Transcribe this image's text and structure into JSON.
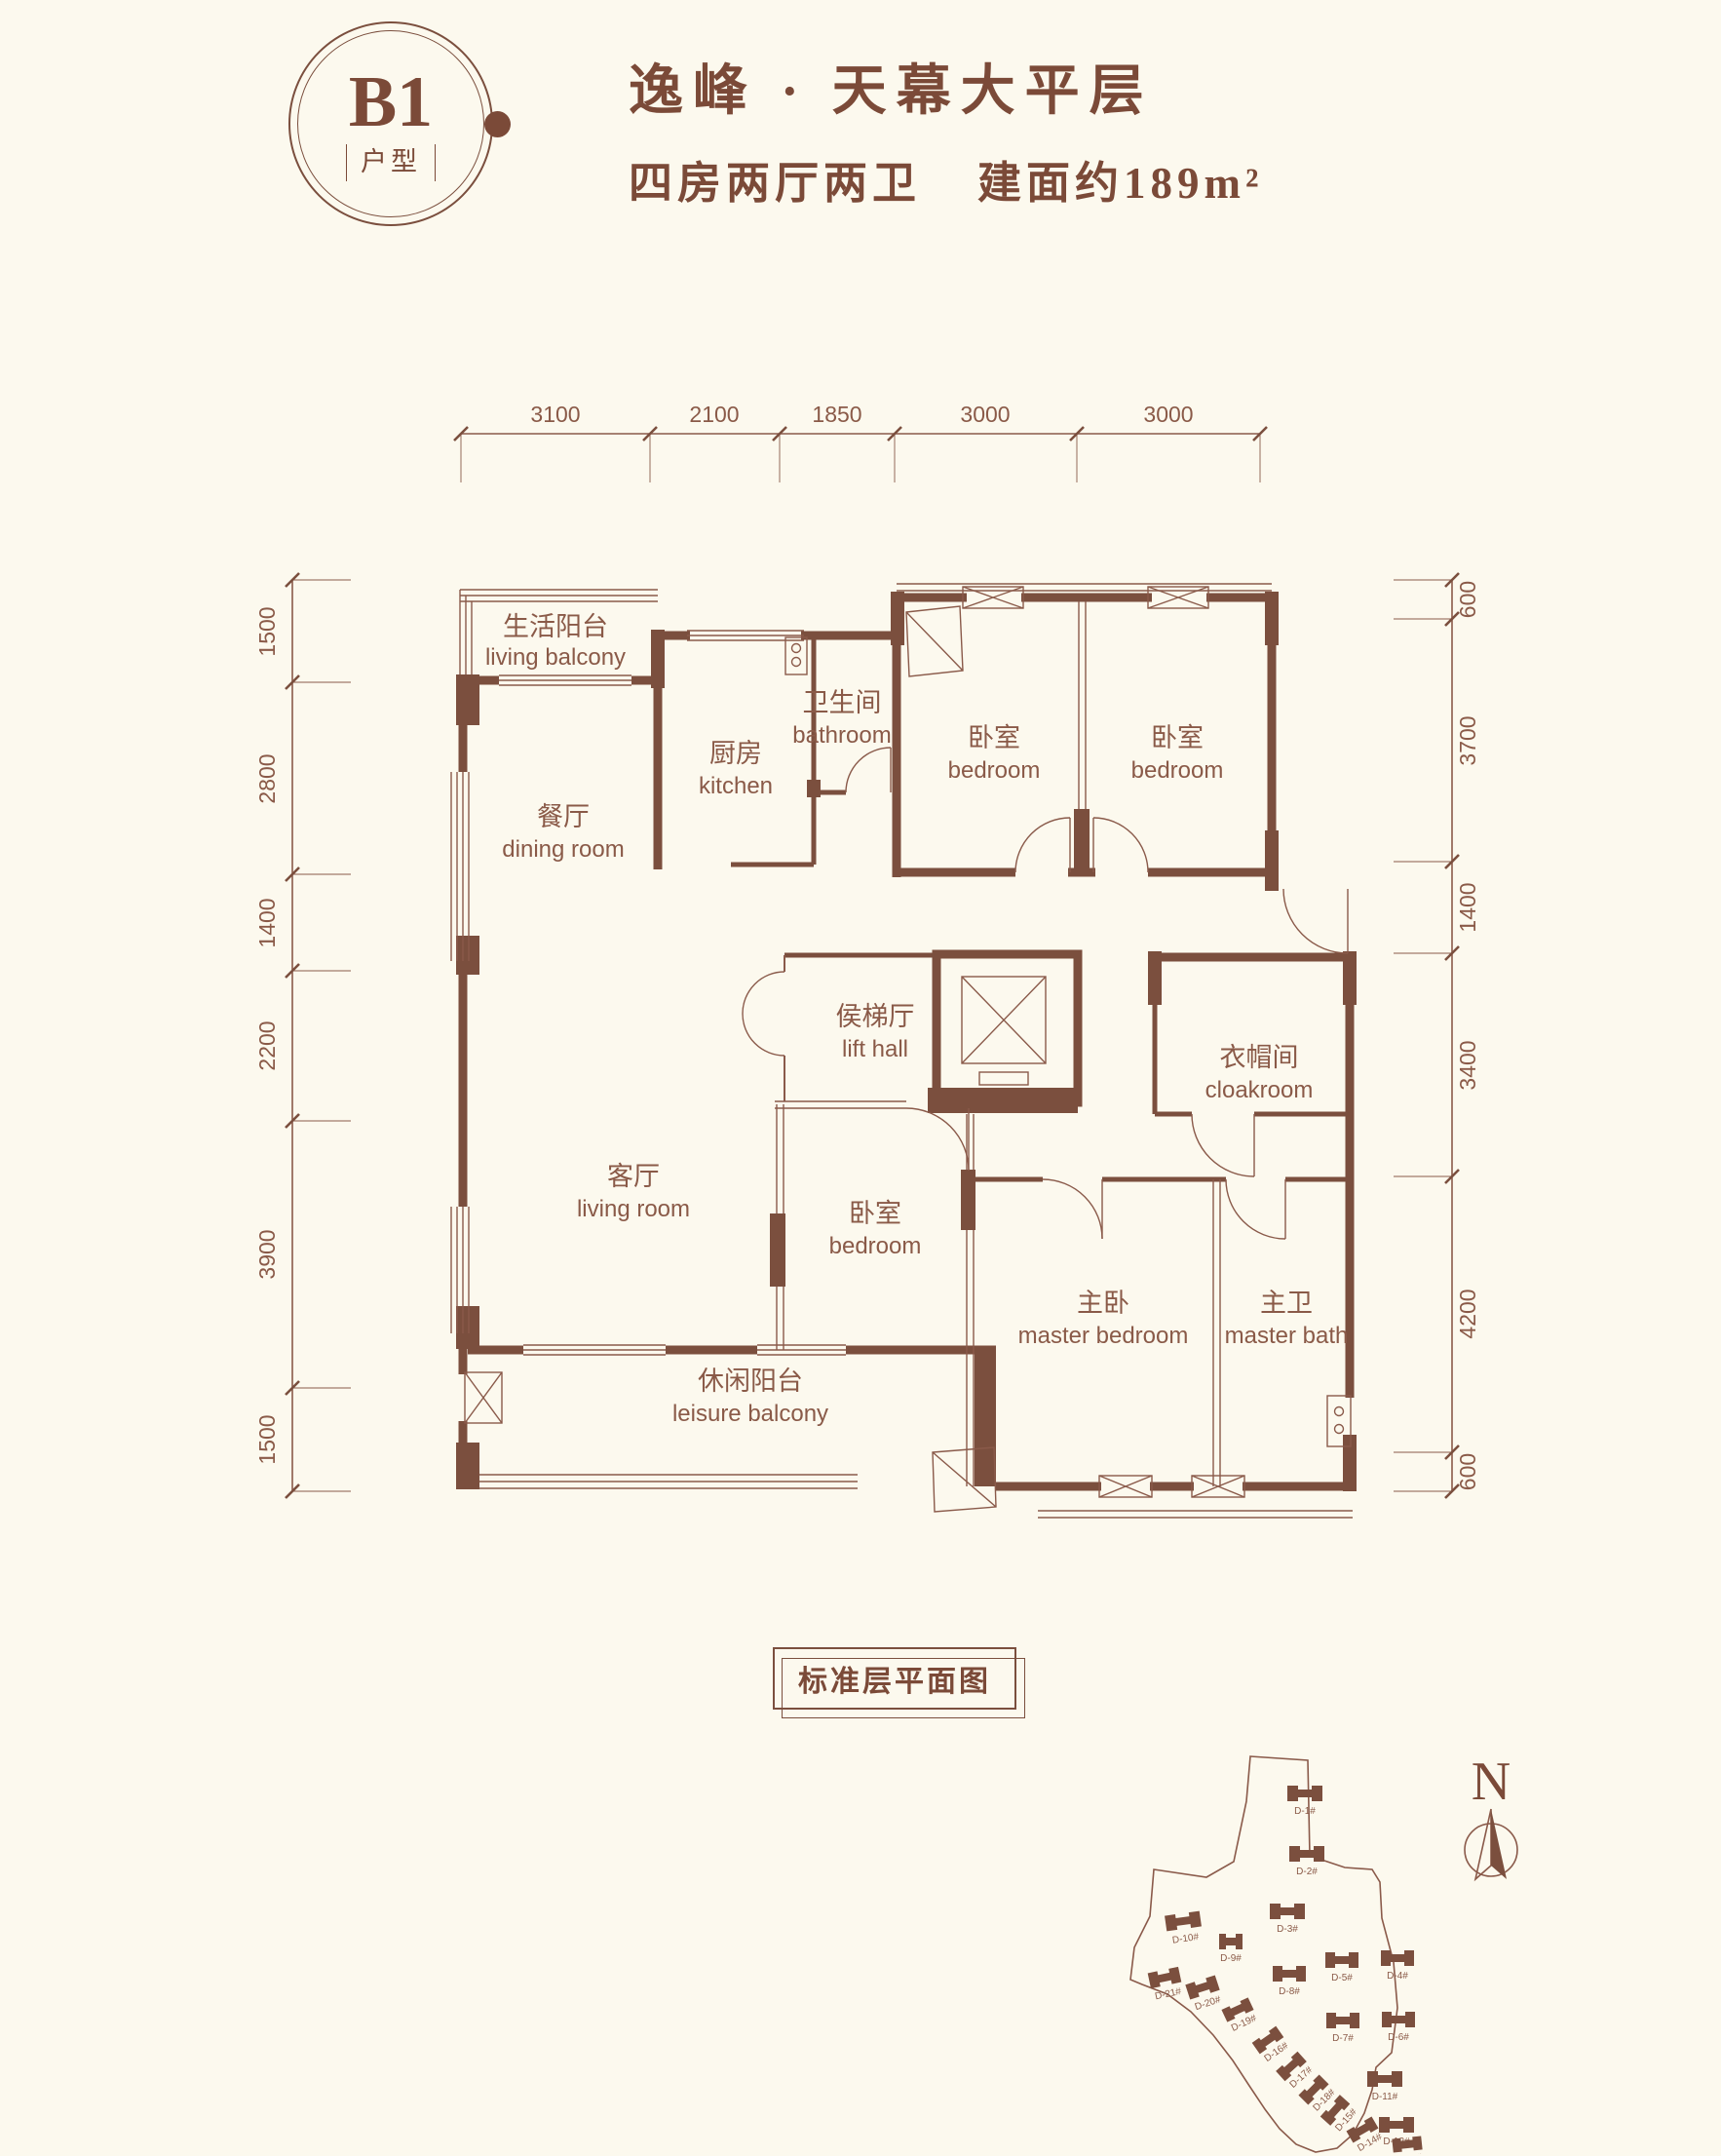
{
  "page": {
    "background": "#fcf9ee",
    "accent": "#8a5a48",
    "wall_color": "#7b4f3e"
  },
  "header": {
    "badge": {
      "code": "B1",
      "label": "户型"
    },
    "title": "逸峰 · 天幕大平层",
    "subtitle": {
      "rooms": "四房两厅两卫",
      "area": "建面约189m²"
    }
  },
  "floor_plan": {
    "rooms": {
      "living_balcony": {
        "cn": "生活阳台",
        "en": "living balcony"
      },
      "dining_room": {
        "cn": "餐厅",
        "en": "dining room"
      },
      "kitchen": {
        "cn": "厨房",
        "en": "kitchen"
      },
      "bathroom": {
        "cn": "卫生间",
        "en": "bathroom"
      },
      "bedroom_top_left": {
        "cn": "卧室",
        "en": "bedroom"
      },
      "bedroom_top_right": {
        "cn": "卧室",
        "en": "bedroom"
      },
      "lift_hall": {
        "cn": "侯梯厅",
        "en": "lift hall"
      },
      "cloakroom": {
        "cn": "衣帽间",
        "en": "cloakroom"
      },
      "living_room": {
        "cn": "客厅",
        "en": "living room"
      },
      "bedroom_middle": {
        "cn": "卧室",
        "en": "bedroom"
      },
      "master_bedroom": {
        "cn": "主卧",
        "en": "master bedroom"
      },
      "master_bath": {
        "cn": "主卫",
        "en": "master bath"
      },
      "leisure_balcony": {
        "cn": "休闲阳台",
        "en": "leisure balcony"
      }
    },
    "dimensions": {
      "top": [
        "3100",
        "2100",
        "1850",
        "3000",
        "3000"
      ],
      "bottom": [
        "5200",
        "3200",
        "3900",
        "2100"
      ],
      "left": [
        "1500",
        "2800",
        "1400",
        "2200",
        "3900",
        "1500"
      ],
      "right": [
        "600",
        "3700",
        "1400",
        "3400",
        "4200",
        "600"
      ]
    }
  },
  "footer": {
    "label": "标准层平面图"
  },
  "site_plan": {
    "north_label": "N",
    "buildings": [
      {
        "label": "D-1#"
      },
      {
        "label": "D-2#"
      },
      {
        "label": "D-3#"
      },
      {
        "label": "D-4#"
      },
      {
        "label": "D-5#"
      },
      {
        "label": "D-6#"
      },
      {
        "label": "D-7#"
      },
      {
        "label": "D-8#"
      },
      {
        "label": "D-9#"
      },
      {
        "label": "D-10#"
      },
      {
        "label": "D-11#"
      },
      {
        "label": "D-12#"
      },
      {
        "label": "D-13#"
      },
      {
        "label": "D-14#"
      },
      {
        "label": "D-15#"
      },
      {
        "label": "D-16#"
      },
      {
        "label": "D-17#"
      },
      {
        "label": "D-18#"
      },
      {
        "label": "D-19#"
      },
      {
        "label": "D-20#"
      },
      {
        "label": "D-21#"
      }
    ]
  }
}
